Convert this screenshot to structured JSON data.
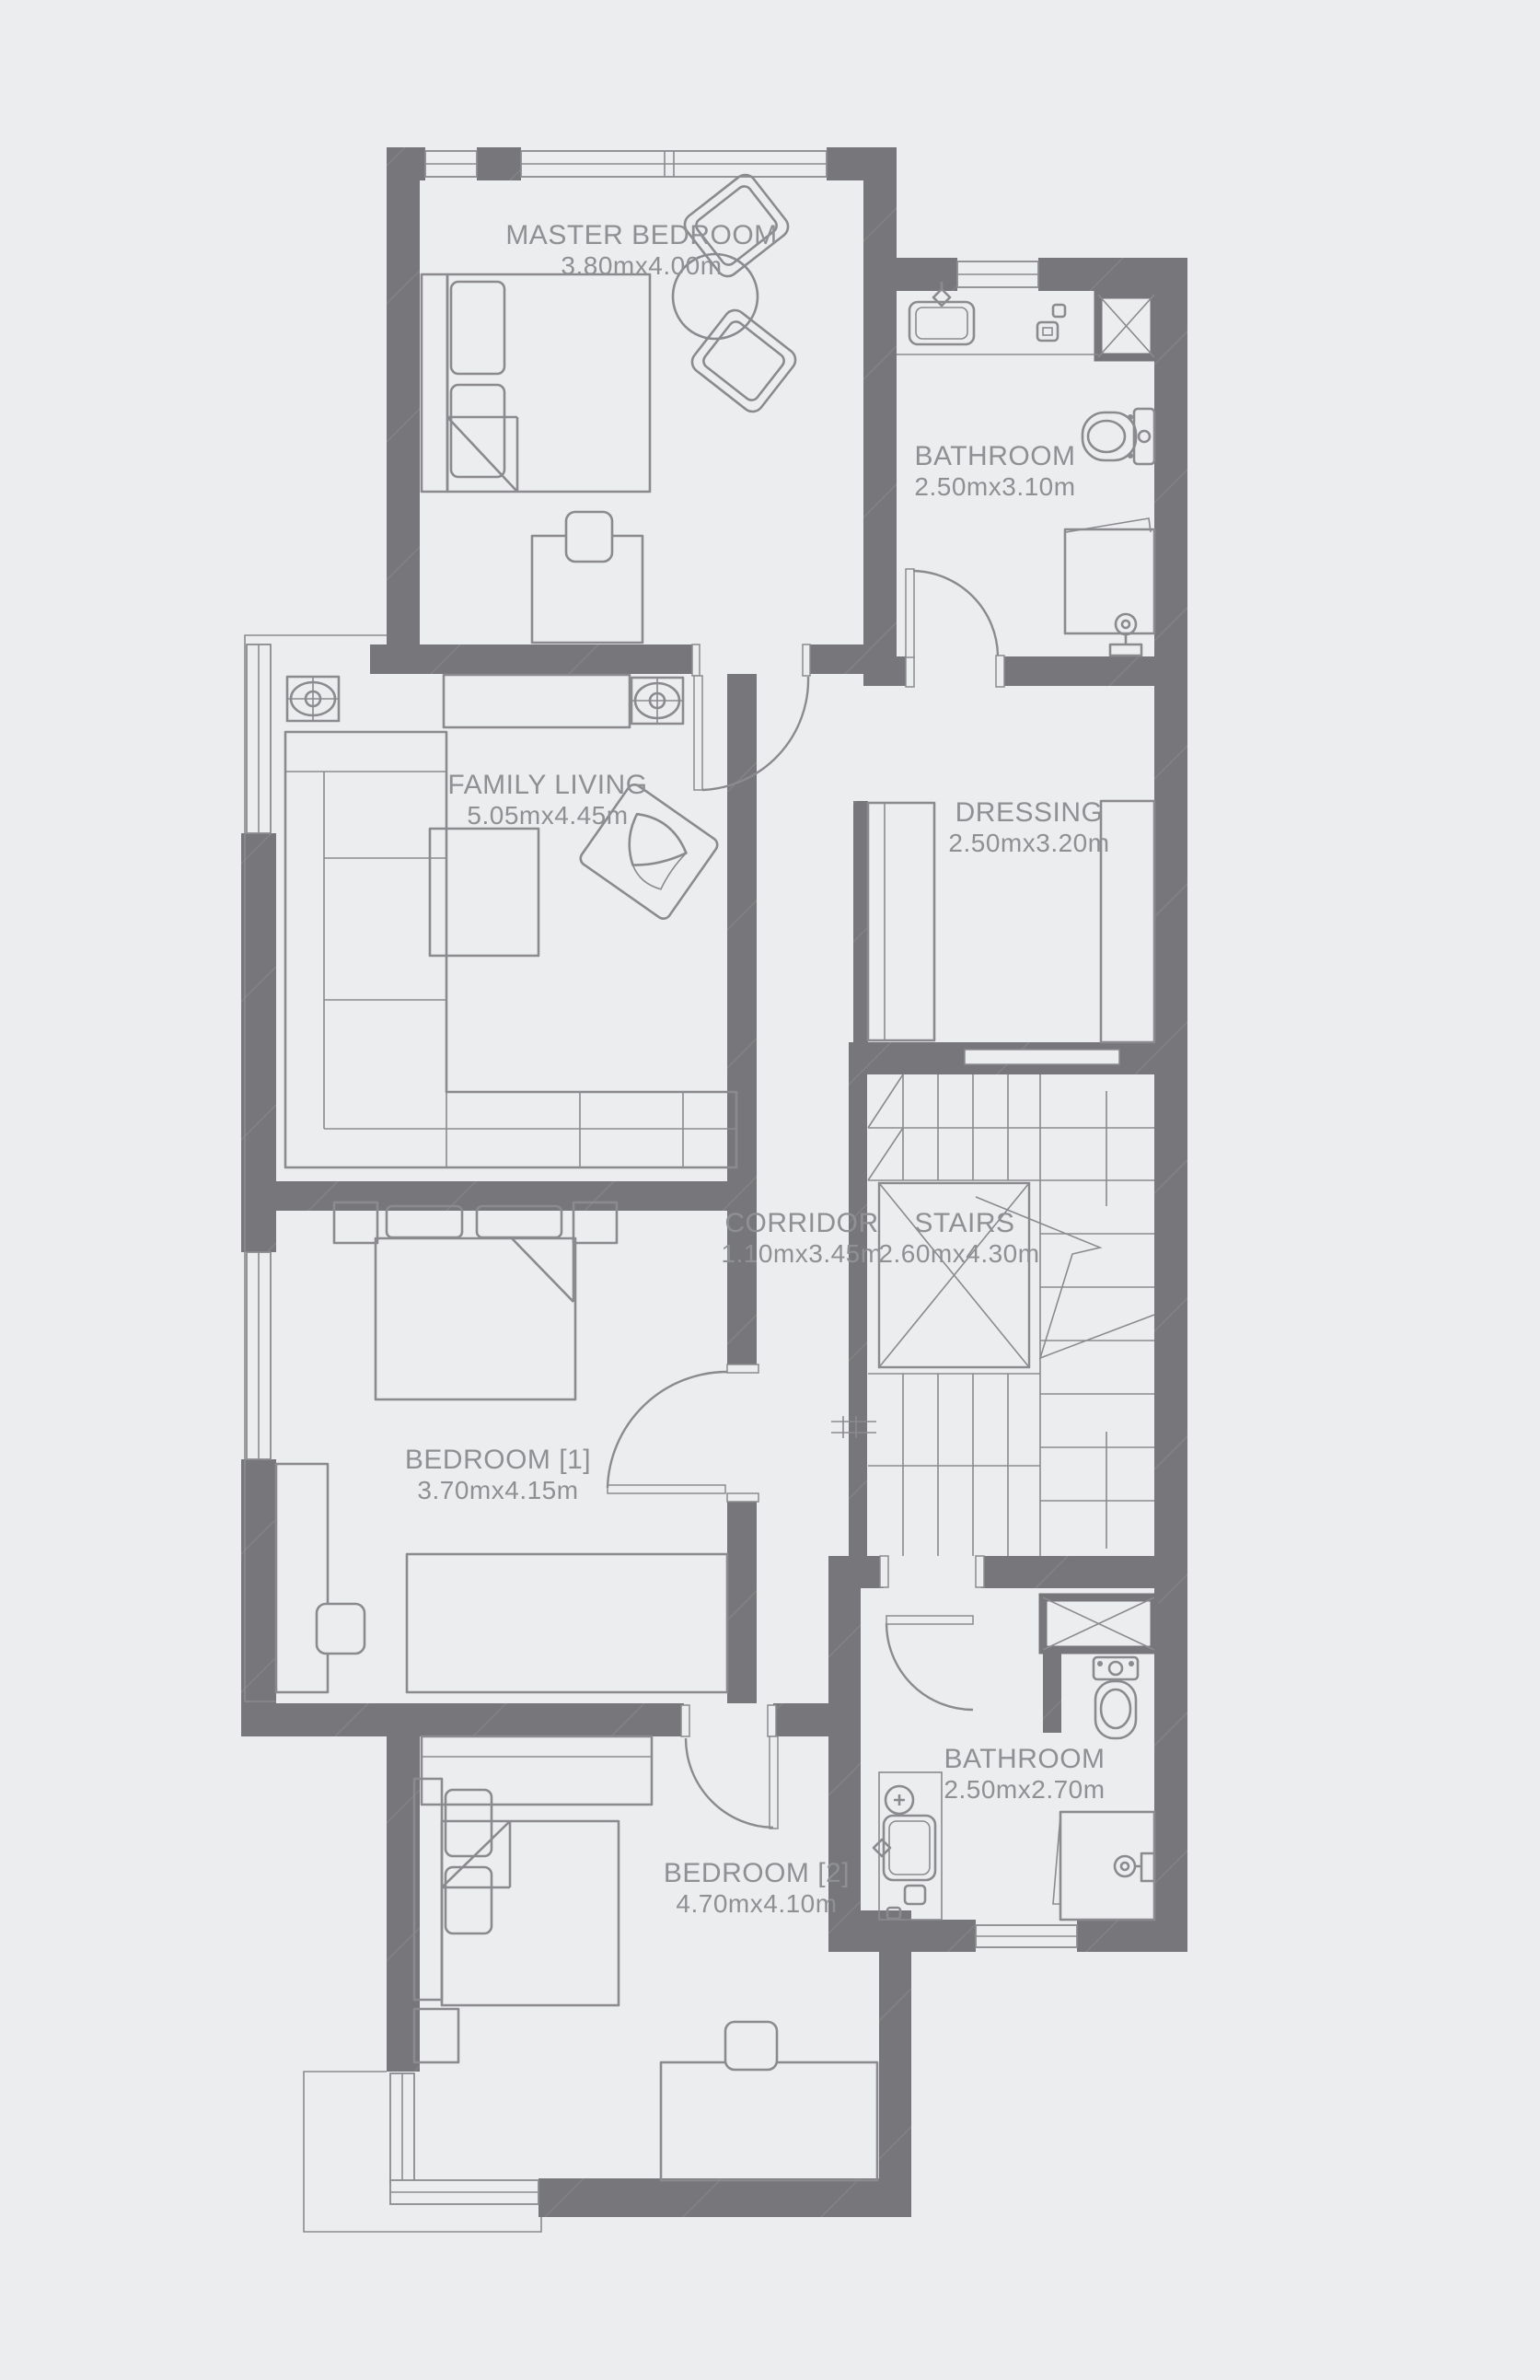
{
  "plan": {
    "type": "floor-plan",
    "rooms": {
      "master_bedroom": {
        "name": "MASTER BEDROOM",
        "dims": "3.80mx4.00m"
      },
      "bathroom_top": {
        "name": "BATHROOM",
        "dims": "2.50mx3.10m"
      },
      "family_living": {
        "name": "FAMILY LIVING",
        "dims": "5.05mx4.45m"
      },
      "dressing": {
        "name": "DRESSING",
        "dims": "2.50mx3.20m"
      },
      "corridor": {
        "name": "CORRIDOR",
        "dims": "1.10mx3.45m"
      },
      "stairs": {
        "name": "STAIRS",
        "dims": "2.60mx4.30m"
      },
      "bedroom_1": {
        "name": "BEDROOM [1]",
        "dims": "3.70mx4.15m"
      },
      "bathroom_bottom": {
        "name": "BATHROOM",
        "dims": "2.50mx2.70m"
      },
      "bedroom_2": {
        "name": "BEDROOM [2]",
        "dims": "4.70mx4.10m"
      }
    },
    "colors": {
      "background": "#ecedee",
      "wall": "#77777b",
      "wall_hatch": "#8e8e92",
      "line": "#8b8b8f",
      "text": "#8f9094"
    }
  }
}
